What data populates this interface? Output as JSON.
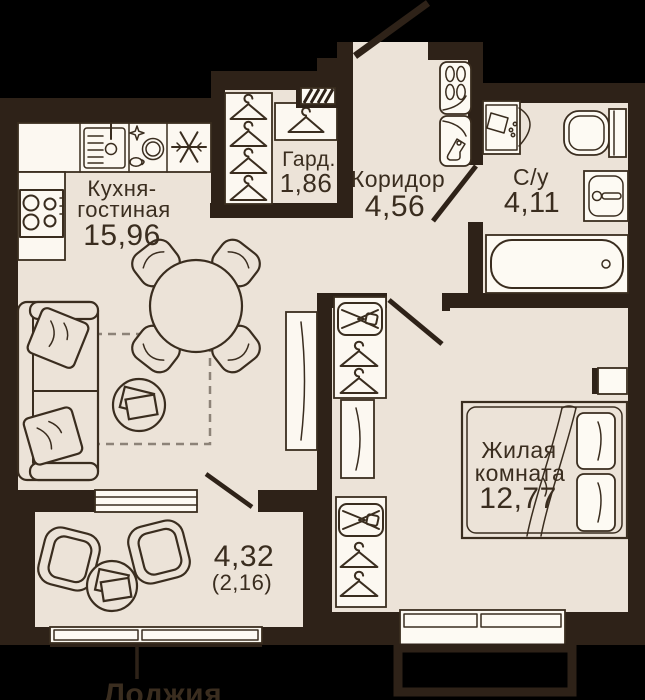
{
  "rooms": {
    "kitchen_living": {
      "label_line1": "Кухня-",
      "label_line2": "гостиная",
      "area": "15,96"
    },
    "wardrobe": {
      "label": "Гард.",
      "area": "1,86"
    },
    "corridor": {
      "label": "Коридор",
      "area": "4,56"
    },
    "bathroom": {
      "label": "С/у",
      "area": "4,11"
    },
    "bedroom": {
      "label_line1": "Жилая",
      "label_line2": "комната",
      "area": "12,77"
    },
    "loggia": {
      "area_full": "4,32",
      "area_coefficient": "(2,16)",
      "callout_label": "Лоджия"
    }
  },
  "colors": {
    "background": "#000000",
    "wall": "#2e2218",
    "floor": "#ece3d8",
    "fixture_fill": "#fcf8f1",
    "line": "#3a2d1f",
    "dashed_zone": "#8d8378"
  }
}
